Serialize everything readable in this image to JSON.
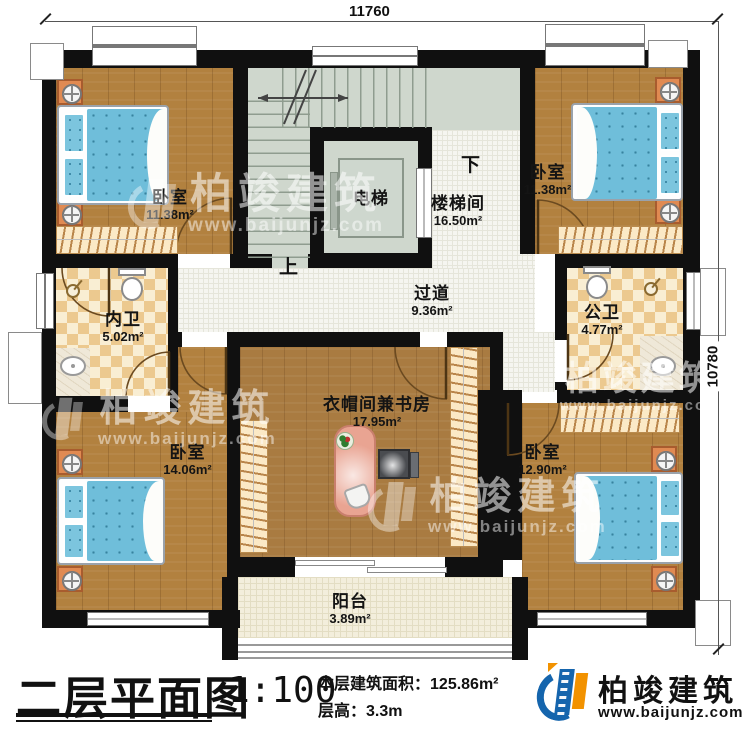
{
  "dimensions": {
    "width_mm": "11760",
    "height_mm": "10780"
  },
  "rooms": [
    {
      "id": "bedroom-tl",
      "name": "卧室",
      "area": "11.38m²"
    },
    {
      "id": "elevator",
      "name": "电梯",
      "area": ""
    },
    {
      "id": "stairwell",
      "name": "楼梯间",
      "area": "16.50m²"
    },
    {
      "id": "bedroom-tr",
      "name": "卧室",
      "area": "11.38m²"
    },
    {
      "id": "inner-bath",
      "name": "内卫",
      "area": "5.02m²"
    },
    {
      "id": "hallway",
      "name": "过道",
      "area": "9.36m²"
    },
    {
      "id": "public-bath",
      "name": "公卫",
      "area": "4.77m²"
    },
    {
      "id": "study",
      "name": "衣帽间兼书房",
      "area": "17.95m²"
    },
    {
      "id": "bedroom-bl",
      "name": "卧室",
      "area": "14.06m²"
    },
    {
      "id": "bedroom-br",
      "name": "卧室",
      "area": "12.90m²"
    },
    {
      "id": "balcony",
      "name": "阳台",
      "area": "3.89m²"
    }
  ],
  "stairs": {
    "up": "上",
    "down": "下"
  },
  "title_block": {
    "plan_name": "二层平面图",
    "scale": "1:100",
    "area_label": "本层建筑面积：",
    "area_value": "125.86m²",
    "height_label": "层高：",
    "height_value": "3.3m"
  },
  "branding": {
    "company": "柏竣建筑",
    "website": "www.baijunjz.com",
    "logo_blue": "#1565ad",
    "logo_orange": "#f29200"
  },
  "watermark": {
    "company": "柏竣建筑",
    "website": "www.baijunjz.com"
  }
}
